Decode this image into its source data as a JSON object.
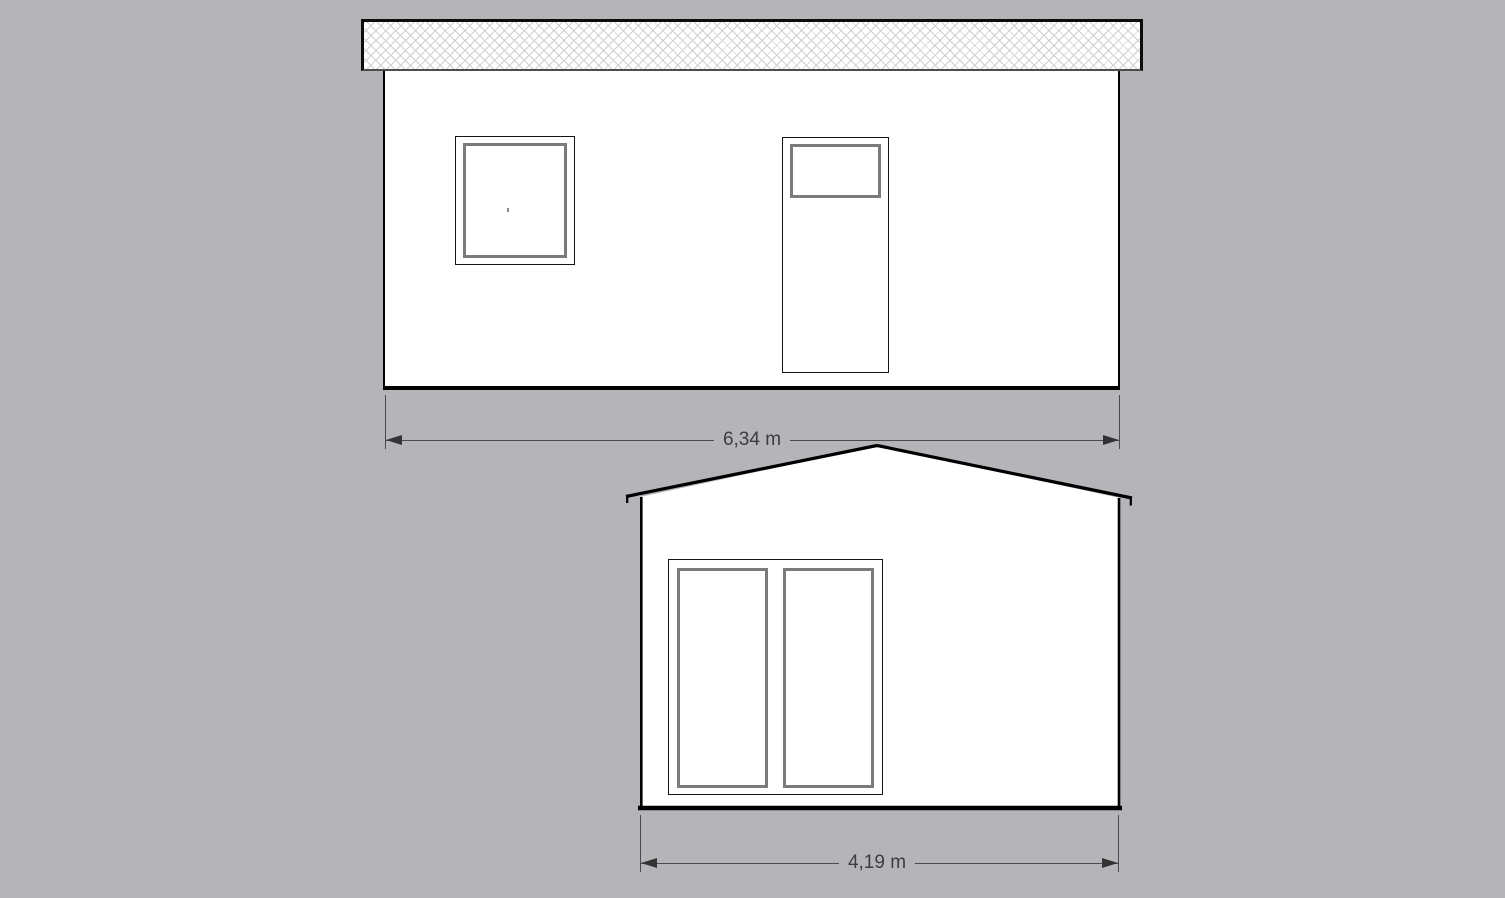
{
  "canvas": {
    "background_color": "#b5b5b9",
    "outline_color": "#000000",
    "window_frame_color": "#7b7b7b",
    "dimension_color": "#3d3d3d",
    "hatch_color": "#cfcfcf",
    "fill_color": "#ffffff"
  },
  "side_elevation": {
    "dimension_label": "6,34 m"
  },
  "gable_elevation": {
    "dimension_label": "4,19 m"
  }
}
